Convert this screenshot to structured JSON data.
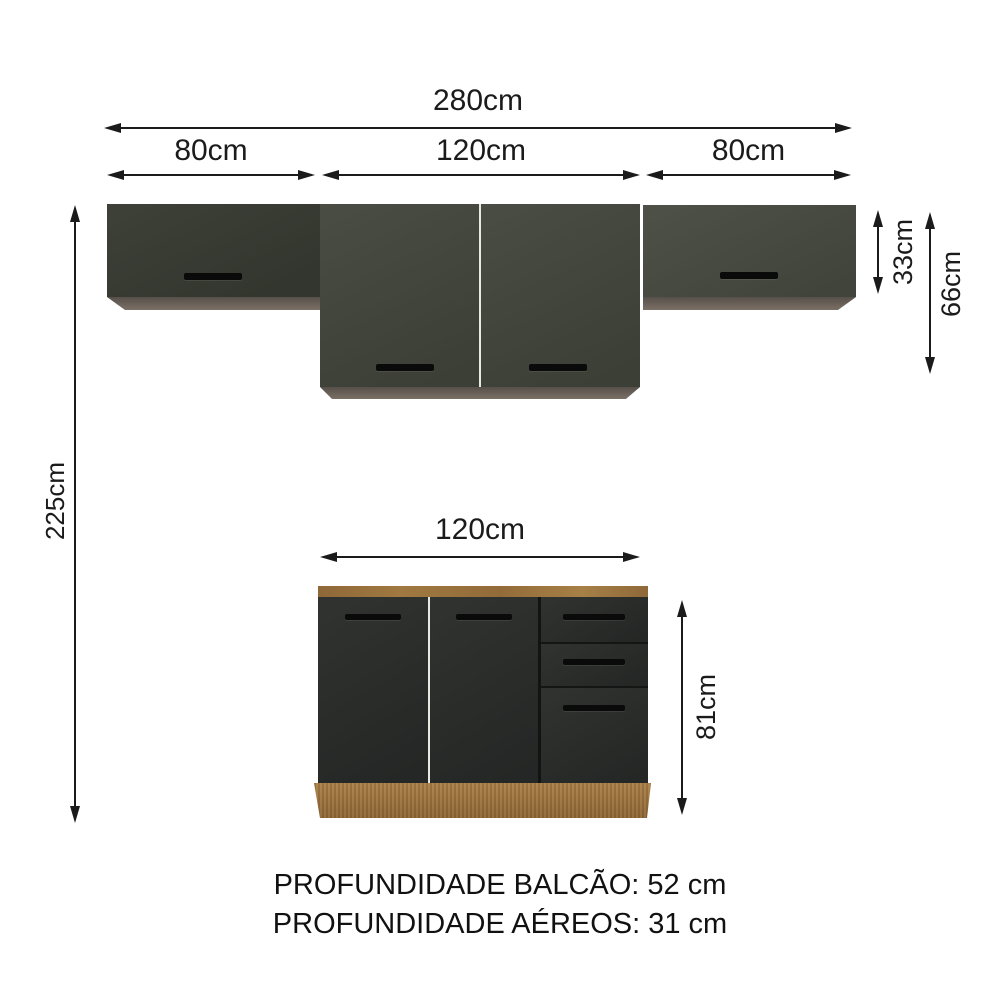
{
  "colors": {
    "background": "#ffffff",
    "dimension_ink": "#1b1b1b",
    "upper_cabinet_door": "#44473e",
    "lower_cabinet_door": "#2d2f2c",
    "cabinet_bottom_edge": "#6f655a",
    "wood": "#a0773f",
    "handle": "#0a0a0a"
  },
  "dimensions": {
    "total_width": "280cm",
    "upper_segments": [
      "80cm",
      "120cm",
      "80cm"
    ],
    "upper_side_height": "33cm",
    "upper_center_height": "66cm",
    "overall_height": "225cm",
    "counter_width": "120cm",
    "counter_height": "81cm"
  },
  "notes": [
    "PROFUNDIDADE BALCÃO: 52 cm",
    "PROFUNDIDADE AÉREOS: 31 cm"
  ]
}
